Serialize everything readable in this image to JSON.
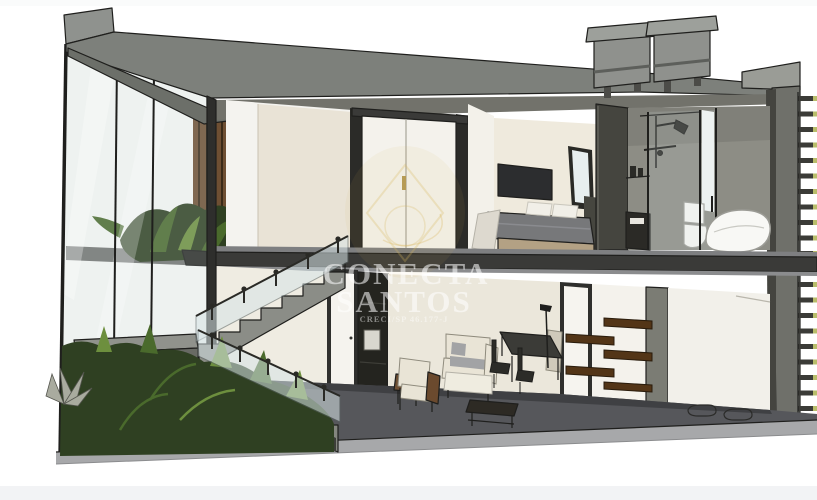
{
  "image": {
    "kind": "3D cutaway cross-section render of a two-story residence",
    "width_px": 817,
    "height_px": 500
  },
  "watermark": {
    "brand_line1": "CONECTA",
    "brand_line2": "SANTOS",
    "license": "CRECI/SP 46.177-J",
    "logo": "gold-diamond-emblem"
  },
  "scene": {
    "roof": [
      "two-water-tanks-on-stands"
    ],
    "upper_floor": [
      "stair-void-with-plant-and-wood-slats",
      "wardrobe-closet-double-doors",
      "bedroom-with-tv-bed-nightstand",
      "bathroom-with-shower-toilet-bathtub"
    ],
    "lower_floor": [
      "switchback-staircase-glass-railing",
      "under-stair-garden",
      "living-room-sofa-armchair",
      "dining-table-chairs",
      "staggered-wall-shelves",
      "utility-room-with-floor-drains"
    ],
    "left_facade": [
      "full-height-glazing"
    ],
    "right_facade": [
      "horizontal-louver-slats"
    ]
  },
  "colors": {
    "background": "#ffffff",
    "footer_strip": "#f2f3f5",
    "roof": "#7d807b",
    "roof_top": "#8f928e",
    "cut_wall": "#3a3a38",
    "ceiling": "#72726b",
    "wall_cream": "#e9e3d6",
    "wall_white": "#f4f2ec",
    "wall_taupe": "#8d8d85",
    "floor": "#56575b",
    "slab_edge": "#a7a8aa",
    "glass": "#e7edee",
    "frame": "#1f1f1d",
    "plant_dark": "#2f4022",
    "plant_mid": "#4a6a2c",
    "plant_light": "#6d8f3e",
    "wood": "#6e4f33",
    "shelf_wood": "#533517",
    "tv": "#2c2d2f",
    "bedding": "#77787a",
    "pillow": "#f1efe8",
    "bedskirt": "#b3a184",
    "sofa": "#e9e4d6",
    "cushion": "#a2a3a5",
    "fixture_white": "#f8f8f5",
    "tank": "#8f918d",
    "louver_tip": "#b9bd6a",
    "gold": "#d9b65c",
    "watermark_text": "#ffffff"
  }
}
